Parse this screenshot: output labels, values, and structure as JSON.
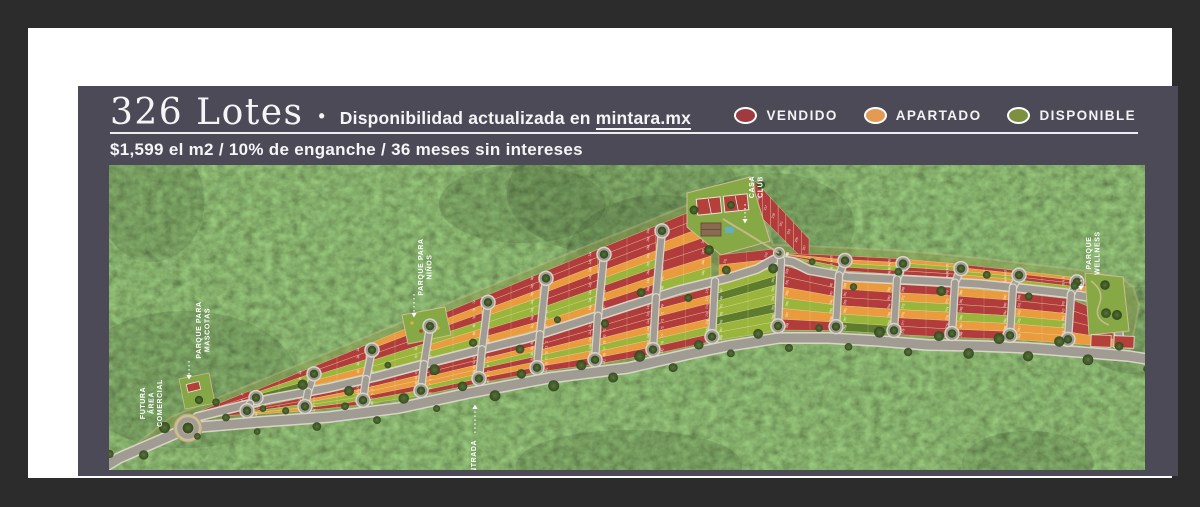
{
  "header": {
    "title": "326 Lotes",
    "bullet": "•",
    "subtitle_prefix": "Disponibilidad actualizada en ",
    "subtitle_link": "mintara.mx",
    "price_line": "$1,599 el m2 / 10% de enganche / 36 meses sin intereses"
  },
  "legend": {
    "items": [
      {
        "label": "VENDIDO",
        "color": "#9e3a40",
        "status": "vendido"
      },
      {
        "label": "APARTADO",
        "color": "#e39a52",
        "status": "apartado"
      },
      {
        "label": "DISPONIBLE",
        "color": "#7c9040",
        "status": "disponible"
      }
    ]
  },
  "map": {
    "total_lots": 326,
    "colors": {
      "vendido": "#b23c3c",
      "apartado": "#ea9b3e",
      "disponible": "#9ab53b",
      "disponible_dark": "#5e7c2e",
      "road": "#a09c93",
      "road_edge": "#d9d4c6",
      "lot_line": "#ead9a4",
      "sand": "#cdbd92",
      "lawn": "#86a845",
      "court": "#b3413a",
      "tree_a": "#3e5826",
      "tree_b": "#4a672d",
      "forest_base": "#3a4722",
      "label_text": "#ffffff"
    },
    "labels": [
      {
        "id": "futura-area-comercial",
        "lines": [
          "FUTURA",
          "ÁREA",
          "COMERCIAL"
        ],
        "x": 36,
        "y": 238,
        "arrow": null
      },
      {
        "id": "parque-para-mascotas",
        "lines": [
          "PARQUE PARA",
          "MASCOTAS"
        ],
        "x": 92,
        "y": 165,
        "arrow": {
          "x": 80,
          "y1": 196,
          "y2": 213,
          "dir": "down"
        }
      },
      {
        "id": "entrada",
        "lines": [
          "ENTRADA"
        ],
        "x": 367,
        "y": 294,
        "arrow": {
          "x": 366,
          "y1": 268,
          "y2": 241,
          "dir": "up"
        }
      },
      {
        "id": "parque-para-ninos",
        "lines": [
          "PARQUE PARA",
          "NIÑOS"
        ],
        "x": 314,
        "y": 102,
        "arrow": {
          "x": 305,
          "y1": 129,
          "y2": 151,
          "dir": "down"
        }
      },
      {
        "id": "casa-club",
        "lines": [
          "CASA",
          "CLUB"
        ],
        "x": 645,
        "y": 22,
        "arrow": {
          "x": 636,
          "y1": 39,
          "y2": 57,
          "dir": "down"
        }
      },
      {
        "id": "parque-wellness",
        "lines": [
          "PARQUE",
          "WELLNESS"
        ],
        "x": 982,
        "y": 88,
        "arrow": {
          "x": 972,
          "y1": 111,
          "y2": 124,
          "dir": "down"
        }
      }
    ],
    "geometry": {
      "perimeter": [
        [
          -8,
          304
        ],
        [
          10,
          293
        ],
        [
          79,
          263
        ],
        [
          150,
          257
        ],
        [
          220,
          252
        ],
        [
          290,
          243
        ],
        [
          360,
          228
        ],
        [
          440,
          213
        ],
        [
          519,
          203
        ],
        [
          580,
          189
        ],
        [
          619,
          181
        ],
        [
          670,
          173
        ],
        [
          719,
          173
        ],
        [
          770,
          176
        ],
        [
          819,
          180
        ],
        [
          870,
          181
        ],
        [
          919,
          183
        ],
        [
          970,
          187
        ],
        [
          1019,
          191
        ],
        [
          1044,
          195
        ]
      ],
      "collector": [
        [
          88,
          252
        ],
        [
          160,
          234
        ],
        [
          219,
          223
        ],
        [
          270,
          211
        ],
        [
          319,
          198
        ],
        [
          370,
          185
        ],
        [
          419,
          173
        ],
        [
          470,
          157
        ],
        [
          519,
          141
        ],
        [
          570,
          125
        ],
        [
          619,
          113
        ],
        [
          648,
          104
        ],
        [
          666,
          94
        ],
        [
          684,
          97
        ],
        [
          700,
          105
        ],
        [
          739,
          112
        ],
        [
          780,
          114
        ],
        [
          819,
          116
        ],
        [
          870,
          119
        ],
        [
          919,
          124
        ],
        [
          955,
          128
        ],
        [
          985,
          133
        ],
        [
          1002,
          142
        ],
        [
          1008,
          156
        ],
        [
          1010,
          170
        ]
      ],
      "topedge": [
        [
          62,
          252
        ],
        [
          150,
          216
        ],
        [
          240,
          179
        ],
        [
          330,
          142
        ],
        [
          420,
          105
        ],
        [
          470,
          84
        ],
        [
          520,
          64
        ],
        [
          566,
          45
        ],
        [
          605,
          29
        ],
        [
          641,
          12
        ]
      ],
      "topedge2": [
        [
          641,
          12
        ],
        [
          652,
          44
        ],
        [
          664,
          80
        ],
        [
          700,
          81
        ],
        [
          739,
          83
        ],
        [
          780,
          85
        ],
        [
          819,
          88
        ],
        [
          870,
          93
        ],
        [
          919,
          99
        ],
        [
          955,
          103
        ],
        [
          985,
          107
        ],
        [
          1012,
          113
        ],
        [
          1024,
          122
        ],
        [
          1030,
          140
        ],
        [
          1026,
          162
        ]
      ],
      "roundabout": {
        "x": 79,
        "y": 263,
        "r": 14
      },
      "club_loop": {
        "x": 670,
        "y": 88,
        "r": 5.5
      },
      "streets": [
        {
          "x": 141,
          "up": true,
          "down": true
        },
        {
          "x": 199,
          "up": true,
          "down": true
        },
        {
          "x": 257,
          "up": true,
          "down": true
        },
        {
          "x": 315,
          "up": true,
          "down": true
        },
        {
          "x": 373,
          "up": true,
          "down": true
        },
        {
          "x": 431,
          "up": true,
          "down": true
        },
        {
          "x": 489,
          "up": true,
          "down": true
        },
        {
          "x": 547,
          "up": true,
          "down": true
        },
        {
          "x": 606,
          "up": false,
          "down": true
        },
        {
          "x": 672,
          "up": false,
          "down": true
        },
        {
          "x": 730,
          "up": true,
          "down": true
        },
        {
          "x": 788,
          "up": true,
          "down": true
        },
        {
          "x": 846,
          "up": true,
          "down": true
        },
        {
          "x": 904,
          "up": true,
          "down": true
        },
        {
          "x": 962,
          "up": true,
          "down": true
        }
      ],
      "blocks": [
        {
          "x1": 80,
          "x2": 141,
          "side": "tip",
          "colors": "RRGR"
        },
        {
          "x1": 141,
          "x2": 199,
          "side": "down",
          "colors": "RRGO"
        },
        {
          "x1": 141,
          "x2": 199,
          "side": "up",
          "colors": "RGD"
        },
        {
          "x1": 199,
          "x2": 257,
          "side": "down",
          "colors": "ROGGR"
        },
        {
          "x1": 199,
          "x2": 257,
          "side": "up",
          "colors": "RRGO"
        },
        {
          "x1": 257,
          "x2": 315,
          "side": "down",
          "colors": "ROORG"
        },
        {
          "x1": 257,
          "x2": 315,
          "side": "up",
          "colors": "ORRGG"
        },
        {
          "x1": 315,
          "x2": 373,
          "side": "down",
          "colors": "RROOGR"
        },
        {
          "x1": 315,
          "x2": 373,
          "side": "up",
          "colors": "RORGOG"
        },
        {
          "x1": 373,
          "x2": 431,
          "side": "down",
          "colors": "ROGROR"
        },
        {
          "x1": 373,
          "x2": 431,
          "side": "up",
          "colors": "RROGGRO"
        },
        {
          "x1": 431,
          "x2": 489,
          "side": "down",
          "colors": "RROGOR"
        },
        {
          "x1": 431,
          "x2": 489,
          "side": "up",
          "colors": "RRORRGGO"
        },
        {
          "x1": 489,
          "x2": 547,
          "side": "down",
          "colors": "RRROGOR"
        },
        {
          "x1": 489,
          "x2": 547,
          "side": "up",
          "colors": "RRROGROR"
        },
        {
          "x1": 547,
          "x2": 606,
          "side": "down",
          "colors": "RORROGR"
        },
        {
          "x1": 547,
          "x2": 602,
          "side": "up",
          "colors": "RRORROG"
        },
        {
          "x1": 606,
          "x2": 672,
          "side": "down",
          "colors": "GDGGDGG"
        },
        {
          "x1": 610,
          "x2": 665,
          "side": "h",
          "t1": 90,
          "t2": 84,
          "b1": 110,
          "b2": 104,
          "colors": "RO"
        },
        {
          "x1": 646,
          "x2": 700,
          "side": "v",
          "t1": 16,
          "t2": 74,
          "b1": 46,
          "b2": 100,
          "colors": "RRRRRRR"
        },
        {
          "x1": 672,
          "x2": 730,
          "side": "down",
          "colors": "RROGOR"
        },
        {
          "x1": 672,
          "x2": 730,
          "side": "up",
          "colors": "RORG"
        },
        {
          "x1": 730,
          "x2": 788,
          "side": "down",
          "colors": "ORROGD"
        },
        {
          "x1": 730,
          "x2": 788,
          "side": "up",
          "colors": "ROGR"
        },
        {
          "x1": 788,
          "x2": 846,
          "side": "down",
          "colors": "ROGORR"
        },
        {
          "x1": 788,
          "x2": 846,
          "side": "up",
          "colors": "OGRR"
        },
        {
          "x1": 846,
          "x2": 904,
          "side": "down",
          "colors": "ORRGOR"
        },
        {
          "x1": 846,
          "x2": 904,
          "side": "up",
          "colors": "ROGO"
        },
        {
          "x1": 904,
          "x2": 962,
          "side": "down",
          "colors": "RROGOO"
        },
        {
          "x1": 904,
          "x2": 962,
          "side": "up",
          "colors": "ORRG"
        },
        {
          "x1": 962,
          "x2": 1004,
          "side": "down",
          "colors": "RRRO"
        },
        {
          "x1": 962,
          "x2": 1002,
          "side": "up",
          "colors": "RO"
        }
      ],
      "parks": {
        "playground": [
          [
            293,
            150
          ],
          [
            336,
            142
          ],
          [
            342,
            170
          ],
          [
            299,
            179
          ]
        ],
        "club_lawn": [
          [
            578,
            28
          ],
          [
            641,
            12
          ],
          [
            661,
            76
          ],
          [
            612,
            90
          ],
          [
            578,
            62
          ]
        ],
        "wellness_lawn": [
          [
            976,
            108
          ],
          [
            1014,
            112
          ],
          [
            1020,
            166
          ],
          [
            980,
            170
          ]
        ],
        "dog_park": [
          [
            70,
            214
          ],
          [
            100,
            208
          ],
          [
            106,
            238
          ],
          [
            76,
            244
          ]
        ]
      }
    }
  }
}
